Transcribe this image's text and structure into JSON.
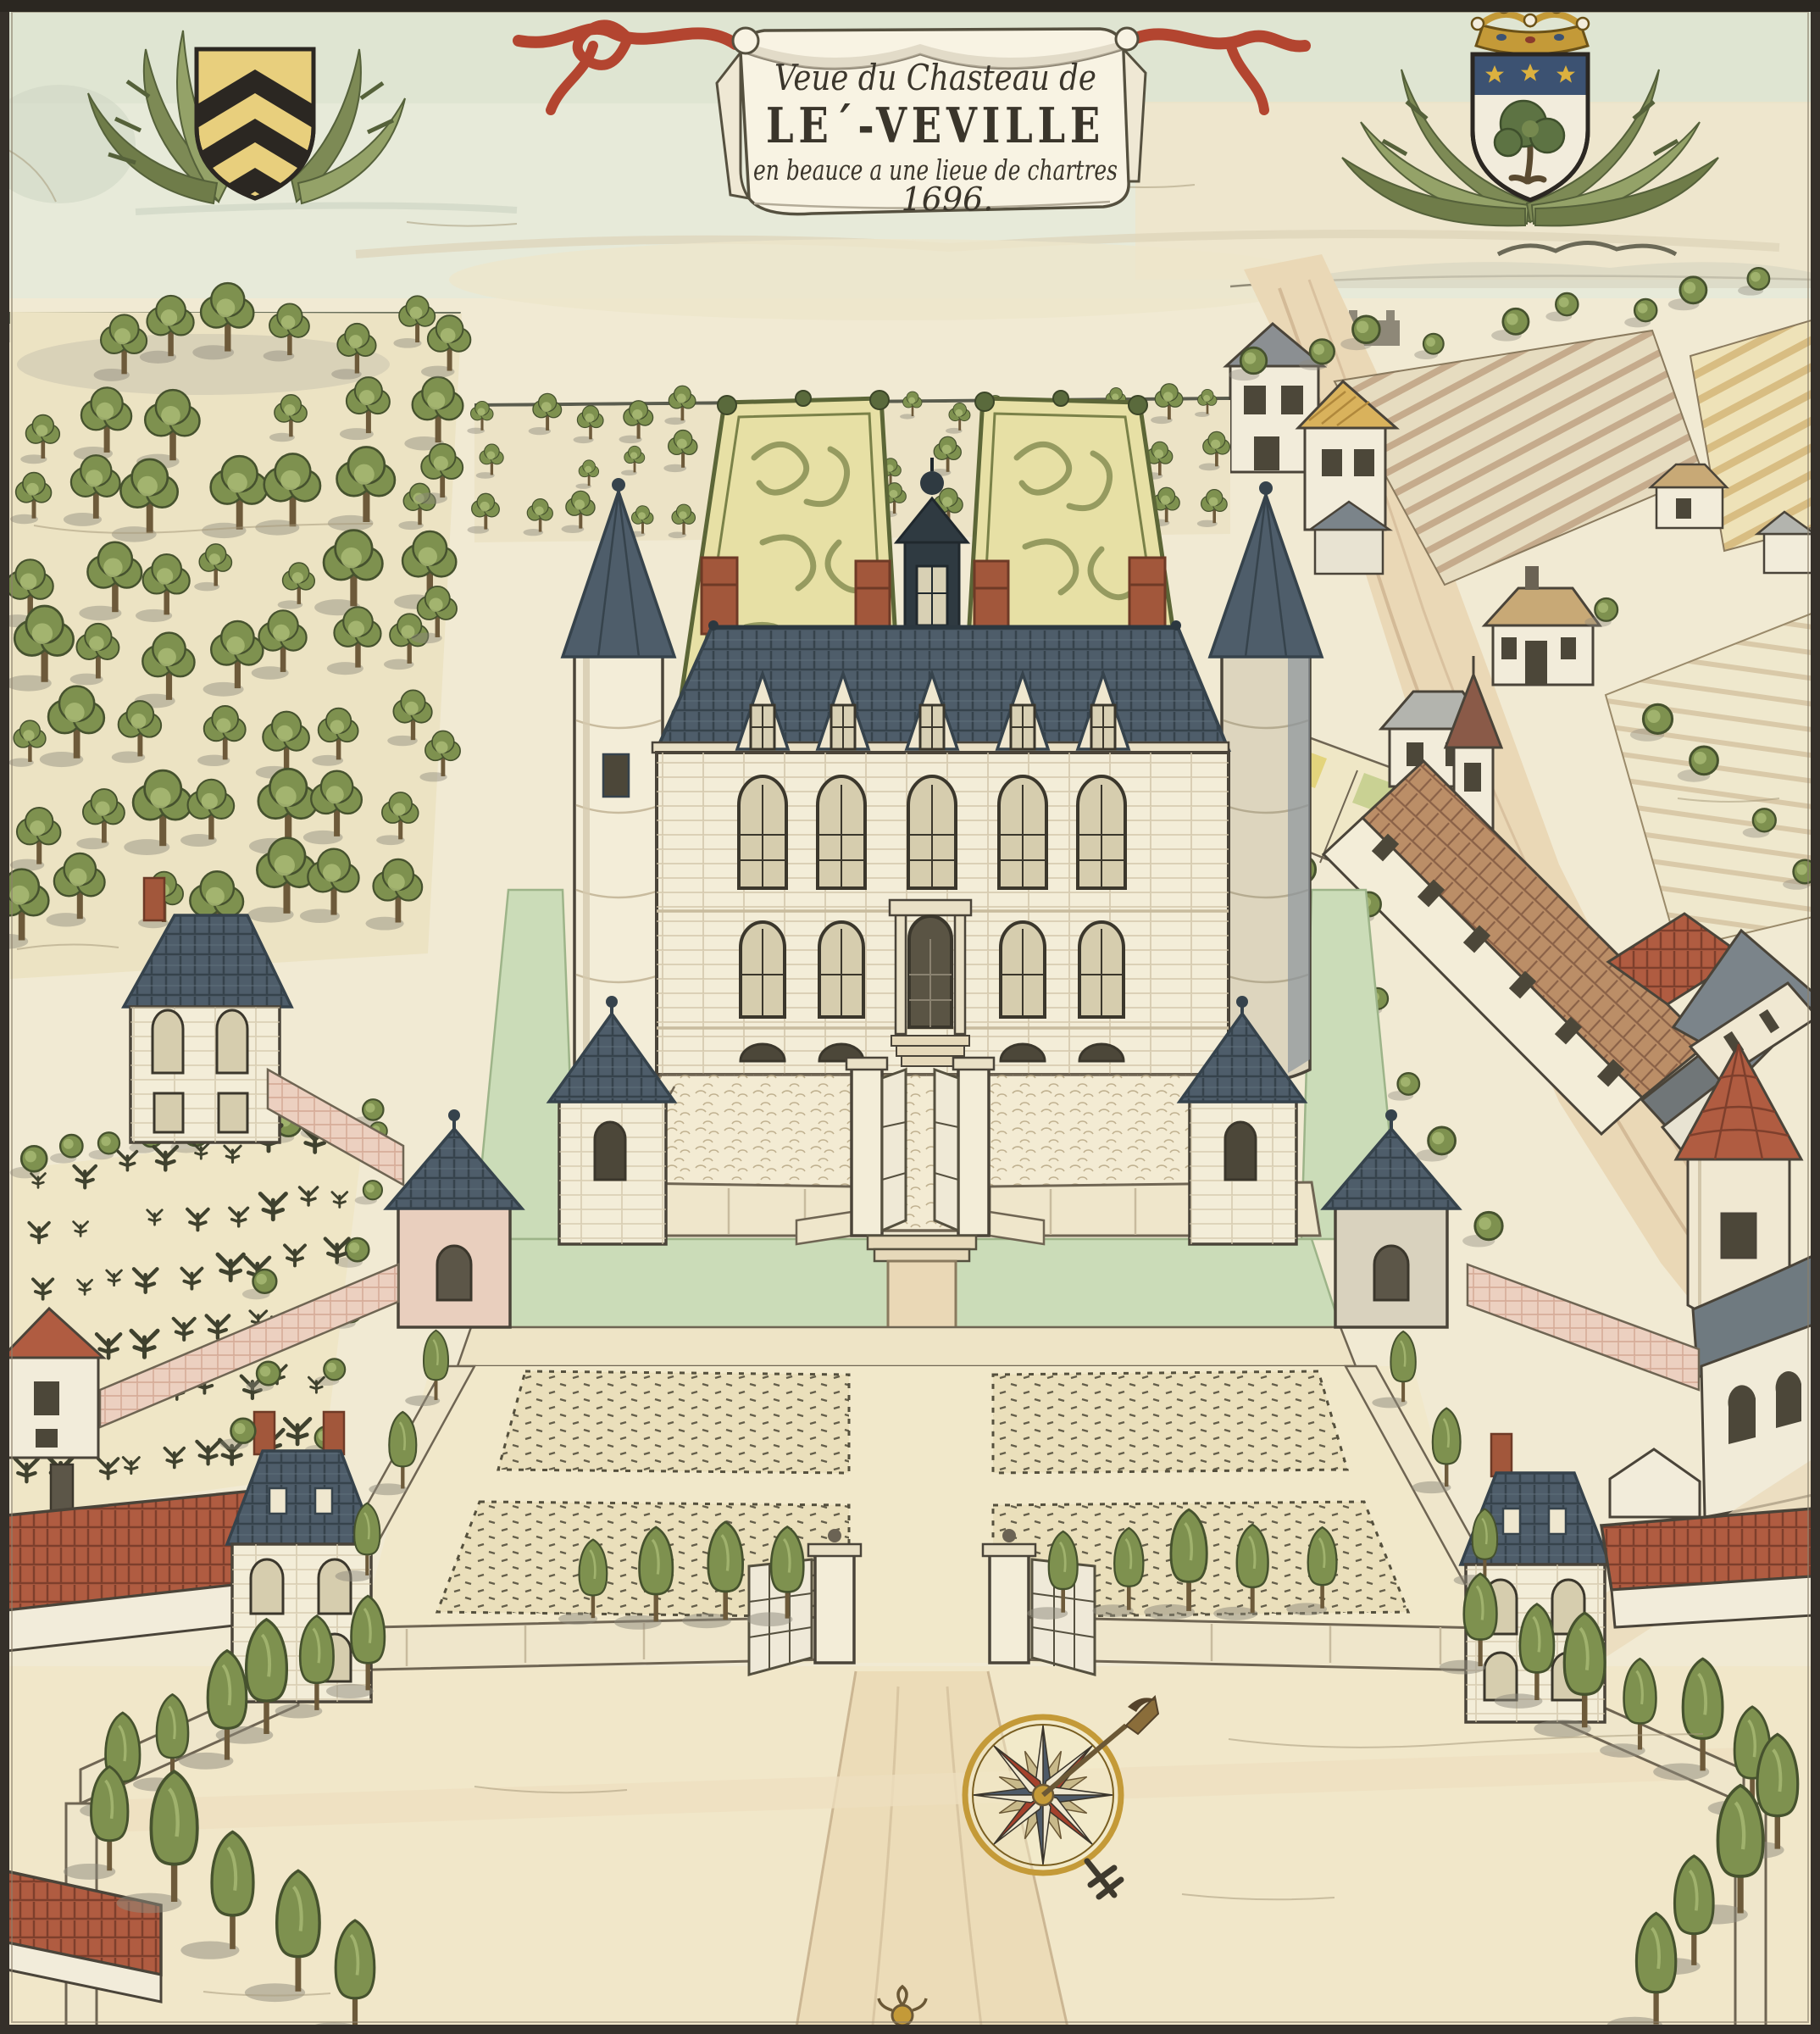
{
  "banner": {
    "line1": "Veue du Chasteau de",
    "line2": "LE´-VEVILLE",
    "line3": "en beauce a une lieue de chartres",
    "line4": "1696."
  },
  "heraldry": {
    "left_shield": "gold shield with three black chevrons in green palm wreath",
    "right_shield": "shield with green tree and three gold stars on blue chief, coronet above, palm wreath"
  },
  "compass": {
    "cardinal_points": 8,
    "intercardinal_points": 8,
    "needle_direction": "north-east"
  },
  "palette": {
    "paper": "#f1ead3",
    "sky": "#e7ead9",
    "ink": "#3a352b",
    "stone": "#f3edd8",
    "stone-line": "#c8bb9e",
    "slate": "#4e5d6a",
    "slate-dark": "#36434c",
    "brick": "#a2573b",
    "tile-red": "#b05c41",
    "moat": "#cbdcb8",
    "leaf": "#7e914f",
    "leaf-dark": "#46522e",
    "leaf-light": "#a9ba74",
    "trunk": "#6d5a3a",
    "parterre": "#e7e0a5",
    "parterre-line": "#8e9459",
    "field": "#ece3c3",
    "sand": "#ead8b6",
    "wall-pink": "#ecd0c0",
    "gold": "#c49a38",
    "ribbon-red": "#b34530",
    "banner-white": "#f8f3e3"
  },
  "vegetation": {
    "seed": 7,
    "regions": [
      {
        "id": "orchard",
        "type": "tree",
        "mode": "grid",
        "quad": [
          52,
          432,
          505,
          415,
          465,
          1075,
          30,
          1100
        ],
        "cols": 7,
        "rows": 8,
        "jitter": 20,
        "scale": 1.05,
        "svar": 0.3,
        "skip": 0.06
      },
      {
        "id": "orchard-edge",
        "type": "tree",
        "mode": "line",
        "from": [
          528,
          440
        ],
        "to": [
          512,
          900
        ],
        "n": 4,
        "jitter": 14,
        "scale": 0.9
      },
      {
        "id": "woodland",
        "type": "tree",
        "mode": "grid",
        "quad": [
          575,
          505,
          1430,
          498,
          1430,
          612,
          575,
          625
        ],
        "cols": 15,
        "rows": 3,
        "jitter": 14,
        "scale": 0.55,
        "svar": 0.25,
        "skip": 0.1
      },
      {
        "id": "woodland-right",
        "type": "bush",
        "mode": "line",
        "from": [
          1470,
          430
        ],
        "to": [
          2090,
          352
        ],
        "n": 9,
        "jitter": 18,
        "scale": 1.25
      },
      {
        "id": "vineyard-vines",
        "type": "vine",
        "mode": "grid",
        "quad": [
          55,
          1395,
          415,
          1345,
          360,
          1705,
          40,
          1745
        ],
        "cols": 9,
        "rows": 6,
        "jitter": 10,
        "scale": 1.5,
        "svar": 0.3,
        "skip": 0.05
      },
      {
        "id": "vineyard-hedge",
        "type": "bush",
        "mode": "line",
        "from": [
          35,
          1372
        ],
        "to": [
          435,
          1322
        ],
        "n": 9,
        "jitter": 8,
        "scale": 1.25
      },
      {
        "id": "vineyard-hedge2",
        "type": "bush",
        "mode": "line",
        "from": [
          448,
          1350
        ],
        "to": [
          385,
          1700
        ],
        "n": 6,
        "jitter": 8,
        "scale": 1.1
      },
      {
        "id": "road-trees",
        "type": "bush",
        "mode": "line",
        "from": [
          1560,
          1020
        ],
        "to": [
          1760,
          1440
        ],
        "n": 6,
        "jitter": 26,
        "scale": 1.3
      },
      {
        "id": "field-trees",
        "type": "bush",
        "mode": "line",
        "from": [
          1905,
          760
        ],
        "to": [
          2120,
          1060
        ],
        "n": 5,
        "jitter": 30,
        "scale": 1.4
      },
      {
        "id": "garden-row-left",
        "type": "trim",
        "mode": "line",
        "from": [
          700,
          1905
        ],
        "to": [
          930,
          1902
        ],
        "n": 4,
        "jitter": 5,
        "scale": 1.05
      },
      {
        "id": "garden-row-right",
        "type": "trim",
        "mode": "line",
        "from": [
          1252,
          1900
        ],
        "to": [
          1560,
          1898
        ],
        "n": 5,
        "jitter": 5,
        "scale": 1.05
      },
      {
        "id": "garden-side-left",
        "type": "trim",
        "mode": "line",
        "from": [
          520,
          1646
        ],
        "to": [
          436,
          1856
        ],
        "n": 3,
        "jitter": 6,
        "scale": 0.85
      },
      {
        "id": "garden-side-right",
        "type": "trim",
        "mode": "line",
        "from": [
          1660,
          1646
        ],
        "to": [
          1748,
          1856
        ],
        "n": 3,
        "jitter": 6,
        "scale": 0.85
      },
      {
        "id": "garden-out-left",
        "type": "bush",
        "mode": "line",
        "from": [
          302,
          1520
        ],
        "to": [
          292,
          1720
        ],
        "n": 3,
        "jitter": 20,
        "scale": 1.2
      },
      {
        "id": "avenue-left-a",
        "type": "trim",
        "mode": "line",
        "from": [
          428,
          1985
        ],
        "to": [
          150,
          2128
        ],
        "n": 6,
        "jitter": 8,
        "scale": 1.15
      },
      {
        "id": "avenue-left-b",
        "type": "trim",
        "mode": "line",
        "from": [
          128,
          2198
        ],
        "to": [
          420,
          2396
        ],
        "n": 5,
        "jitter": 10,
        "scale": 1.3
      },
      {
        "id": "avenue-right-a",
        "type": "trim",
        "mode": "line",
        "from": [
          1748,
          1968
        ],
        "to": [
          2070,
          2120
        ],
        "n": 6,
        "jitter": 8,
        "scale": 1.15
      },
      {
        "id": "avenue-right-b",
        "type": "trim",
        "mode": "line",
        "from": [
          2096,
          2180
        ],
        "to": [
          1962,
          2392
        ],
        "n": 4,
        "jitter": 10,
        "scale": 1.3
      }
    ]
  }
}
